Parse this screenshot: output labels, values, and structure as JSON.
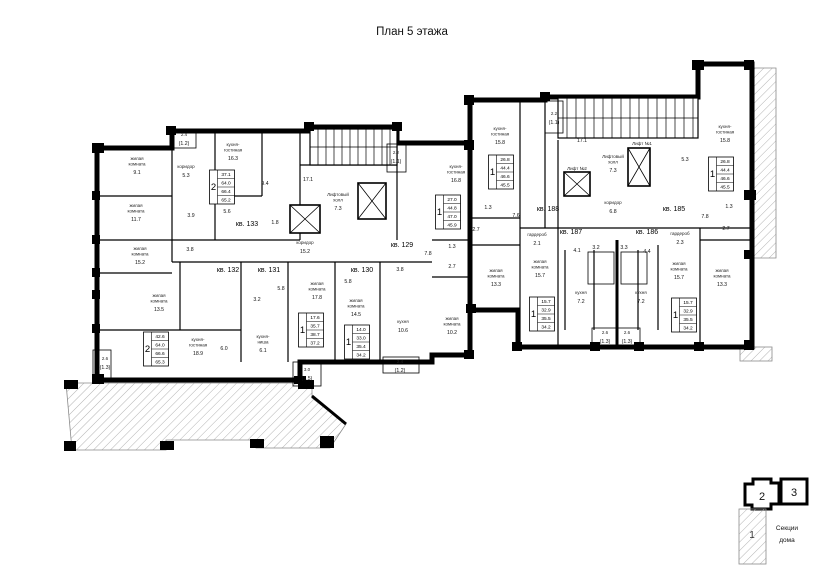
{
  "title": "План 5 этажа",
  "legend": {
    "caption_line1": "Секции",
    "caption_line2": "дома",
    "sections": [
      "1",
      "2",
      "3"
    ]
  },
  "apartments": [
    {
      "num": "кв. 133",
      "count": "2",
      "values": [
        "37.1",
        "64.0",
        "66.4",
        "65.2"
      ],
      "label_x": 247,
      "label_y": 226,
      "box_x": 222,
      "box_y": 187
    },
    {
      "num": "кв. 132",
      "count": "2",
      "values": [
        "42.6",
        "64.0",
        "66.6",
        "65.3"
      ],
      "label_x": 228,
      "label_y": 272,
      "box_x": 156,
      "box_y": 349
    },
    {
      "num": "кв. 131",
      "count": "1",
      "values": [
        "17.6",
        "35.7",
        "38.7",
        "37.2"
      ],
      "label_x": 269,
      "label_y": 272,
      "box_x": 311,
      "box_y": 330
    },
    {
      "num": "кв. 130",
      "count": "1",
      "values": [
        "14.0",
        "33.0",
        "35.4",
        "34.2"
      ],
      "label_x": 362,
      "label_y": 272,
      "box_x": 357,
      "box_y": 342
    },
    {
      "num": "кв. 129",
      "count": "1",
      "values": [
        "27.0",
        "44.8",
        "47.0",
        "45.9"
      ],
      "label_x": 402,
      "label_y": 247,
      "box_x": 448,
      "box_y": 212
    },
    {
      "num": "кв. 188",
      "count": "1",
      "values": [
        "26.8",
        "44.4",
        "46.6",
        "45.5"
      ],
      "label_x": 548,
      "label_y": 211,
      "box_x": 501,
      "box_y": 172
    },
    {
      "num": "кв. 187",
      "count": "1",
      "values": [
        "15.7",
        "32.9",
        "35.5",
        "34.2"
      ],
      "label_x": 571,
      "label_y": 234,
      "box_x": 542,
      "box_y": 314
    },
    {
      "num": "кв. 186",
      "count": "1",
      "values": [
        "15.7",
        "32.9",
        "35.5",
        "34.2"
      ],
      "label_x": 647,
      "label_y": 234,
      "box_x": 684,
      "box_y": 315
    },
    {
      "num": "кв. 185",
      "count": "1",
      "values": [
        "26.8",
        "44.4",
        "46.6",
        "45.5"
      ],
      "label_x": 674,
      "label_y": 211,
      "box_x": 721,
      "box_y": 174
    }
  ],
  "rooms": [
    {
      "lines": [
        "жилая",
        "комната"
      ],
      "area": "9.1",
      "x": 137,
      "y": 160
    },
    {
      "lines": [
        "жилая",
        "комната"
      ],
      "area": "11.7",
      "x": 136,
      "y": 207
    },
    {
      "lines": [
        "жилая",
        "комната"
      ],
      "area": "15.2",
      "x": 140,
      "y": 250
    },
    {
      "lines": [
        "жилая",
        "комната"
      ],
      "area": "13.5",
      "x": 159,
      "y": 297
    },
    {
      "lines": [
        "кухня-",
        "гостиная"
      ],
      "area": "16.3",
      "x": 233,
      "y": 146
    },
    {
      "lines": [
        "коридор"
      ],
      "area": "5.3",
      "x": 186,
      "y": 168
    },
    {
      "lines": [],
      "area": "9.4",
      "x": 265,
      "y": 185
    },
    {
      "lines": [],
      "area": "5.6",
      "x": 227,
      "y": 213
    },
    {
      "lines": [],
      "area": "3.9",
      "x": 191,
      "y": 217
    },
    {
      "lines": [],
      "area": "3.8",
      "x": 190,
      "y": 251
    },
    {
      "lines": [],
      "area": "1.8",
      "x": 275,
      "y": 224
    },
    {
      "lines": [
        "2.4"
      ],
      "area": "(1.2)",
      "x": 184,
      "y": 136
    },
    {
      "lines": [
        "кухня-",
        "гостиная"
      ],
      "area": "18.9",
      "x": 198,
      "y": 341
    },
    {
      "lines": [
        "кухня-",
        "ниша"
      ],
      "area": "6.1",
      "x": 263,
      "y": 338
    },
    {
      "lines": [],
      "area": "6.0",
      "x": 224,
      "y": 350
    },
    {
      "lines": [],
      "area": "3.2",
      "x": 257,
      "y": 301
    },
    {
      "lines": [],
      "area": "5.8",
      "x": 281,
      "y": 290
    },
    {
      "lines": [
        "жилая",
        "комната"
      ],
      "area": "17.8",
      "x": 317,
      "y": 285
    },
    {
      "lines": [
        "жилая",
        "комната"
      ],
      "area": "14.5",
      "x": 356,
      "y": 302
    },
    {
      "lines": [
        "кухня"
      ],
      "area": "10.6",
      "x": 403,
      "y": 323
    },
    {
      "lines": [],
      "area": "5.8",
      "x": 348,
      "y": 283
    },
    {
      "lines": [],
      "area": "3.8",
      "x": 400,
      "y": 271
    },
    {
      "lines": [
        "2.6"
      ],
      "area": "(1.3)",
      "x": 105,
      "y": 360
    },
    {
      "lines": [
        "3.0"
      ],
      "area": "(1.5)",
      "x": 307,
      "y": 371
    },
    {
      "lines": [
        "2.4"
      ],
      "area": "(1.2)",
      "x": 400,
      "y": 363
    },
    {
      "lines": [
        "кухня-",
        "гостиная"
      ],
      "area": "16.8",
      "x": 456,
      "y": 168
    },
    {
      "lines": [
        "жилая",
        "комната"
      ],
      "area": "10.2",
      "x": 452,
      "y": 320
    },
    {
      "lines": [],
      "area": "1.3",
      "x": 452,
      "y": 248
    },
    {
      "lines": [],
      "area": "2.7",
      "x": 452,
      "y": 268
    },
    {
      "lines": [],
      "area": "7.8",
      "x": 428,
      "y": 255
    },
    {
      "lines": [
        "коридор"
      ],
      "area": "15.2",
      "x": 305,
      "y": 244
    },
    {
      "lines": [
        "Лифтовый",
        "холл"
      ],
      "area": "7.3",
      "x": 338,
      "y": 196
    },
    {
      "lines": [],
      "area": "17.1",
      "x": 308,
      "y": 181
    },
    {
      "lines": [
        "2.2"
      ],
      "area": "(1.1)",
      "x": 396,
      "y": 154
    },
    {
      "lines": [
        "кухня-",
        "гостиная"
      ],
      "area": "15.8",
      "x": 500,
      "y": 130
    },
    {
      "lines": [],
      "area": "1.3",
      "x": 488,
      "y": 209
    },
    {
      "lines": [],
      "area": "7.6",
      "x": 516,
      "y": 217
    },
    {
      "lines": [],
      "area": "2.7",
      "x": 476,
      "y": 231
    },
    {
      "lines": [
        "жилая",
        "комната"
      ],
      "area": "13.3",
      "x": 496,
      "y": 272
    },
    {
      "lines": [],
      "area": "17.1",
      "x": 582,
      "y": 142
    },
    {
      "lines": [
        "Лифтовый",
        "холл"
      ],
      "area": "7.3",
      "x": 613,
      "y": 158
    },
    {
      "lines": [
        "Лифт №2"
      ],
      "area": "",
      "x": 577,
      "y": 170
    },
    {
      "lines": [
        "Лифт №1"
      ],
      "area": "",
      "x": 642,
      "y": 145
    },
    {
      "lines": [
        "коридор"
      ],
      "area": "6.8",
      "x": 613,
      "y": 204
    },
    {
      "lines": [
        "2.2"
      ],
      "area": "(1.1)",
      "x": 554,
      "y": 115
    },
    {
      "lines": [
        "гардероб"
      ],
      "area": "2.1",
      "x": 537,
      "y": 236
    },
    {
      "lines": [
        "жилая",
        "комната"
      ],
      "area": "15.7",
      "x": 540,
      "y": 263
    },
    {
      "lines": [
        "кухня"
      ],
      "area": "7.2",
      "x": 581,
      "y": 294
    },
    {
      "lines": [],
      "area": "4.1",
      "x": 577,
      "y": 252
    },
    {
      "lines": [],
      "area": "3.2",
      "x": 596,
      "y": 249
    },
    {
      "lines": [],
      "area": "3.3",
      "x": 624,
      "y": 249
    },
    {
      "lines": [],
      "area": "4.4",
      "x": 647,
      "y": 253
    },
    {
      "lines": [
        "2.6"
      ],
      "area": "(1.3)",
      "x": 605,
      "y": 334
    },
    {
      "lines": [
        "2.6"
      ],
      "area": "(1.3)",
      "x": 627,
      "y": 334
    },
    {
      "lines": [
        "гардероб"
      ],
      "area": "2.3",
      "x": 680,
      "y": 235
    },
    {
      "lines": [
        "жилая",
        "комната"
      ],
      "area": "15.7",
      "x": 679,
      "y": 265
    },
    {
      "lines": [
        "кухня"
      ],
      "area": "7.2",
      "x": 641,
      "y": 294
    },
    {
      "lines": [
        "жилая",
        "комната"
      ],
      "area": "13.3",
      "x": 722,
      "y": 272
    },
    {
      "lines": [
        "кухня-",
        "гостиная"
      ],
      "area": "15.8",
      "x": 725,
      "y": 128
    },
    {
      "lines": [],
      "area": "5.3",
      "x": 685,
      "y": 161
    },
    {
      "lines": [],
      "area": "1.3",
      "x": 729,
      "y": 208
    },
    {
      "lines": [],
      "area": "7.8",
      "x": 705,
      "y": 218
    },
    {
      "lines": [],
      "area": "2.7",
      "x": 726,
      "y": 230
    }
  ]
}
